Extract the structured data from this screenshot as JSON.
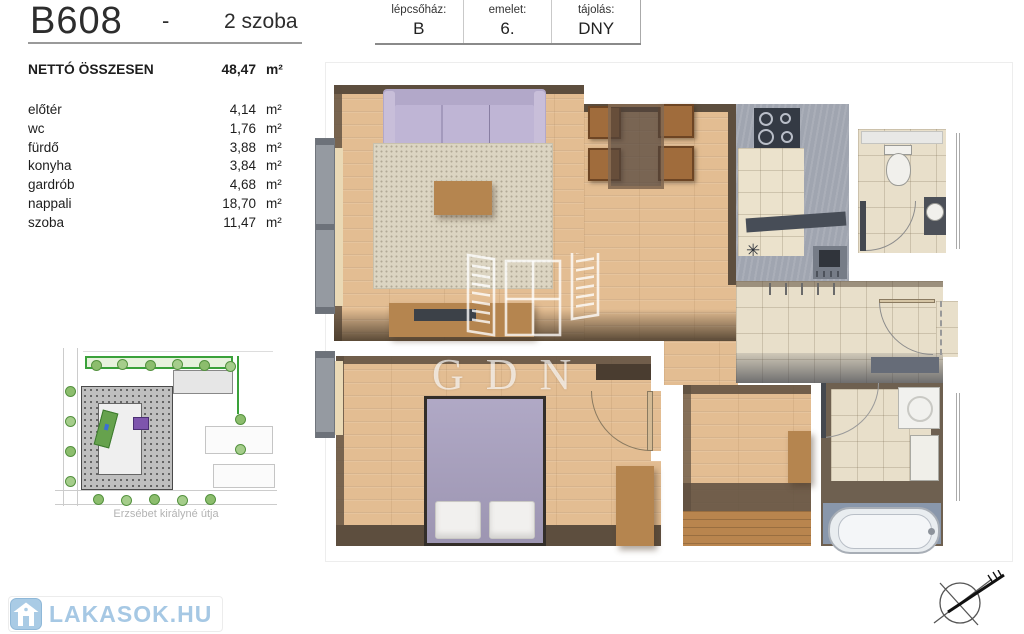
{
  "header": {
    "unit_code": "B608",
    "separator": "-",
    "rooms_label": "2 szoba"
  },
  "info_table": {
    "staircase_label": "lépcsőház:",
    "staircase_value": "B",
    "floor_label": "emelet:",
    "floor_value": "6.",
    "orientation_label": "tájolás:",
    "orientation_value": "DNY"
  },
  "area_table": {
    "total_label": "NETTÓ ÖSSZESEN",
    "total_value": "48,47",
    "total_unit": "m²",
    "rows": [
      {
        "name": "előtér",
        "value": "4,14",
        "unit": "m²"
      },
      {
        "name": "wc",
        "value": "1,76",
        "unit": "m²"
      },
      {
        "name": "fürdő",
        "value": "3,88",
        "unit": "m²"
      },
      {
        "name": "konyha",
        "value": "3,84",
        "unit": "m²"
      },
      {
        "name": "gardrób",
        "value": "4,68",
        "unit": "m²"
      },
      {
        "name": "nappali",
        "value": "18,70",
        "unit": "m²"
      },
      {
        "name": "szoba",
        "value": "11,47",
        "unit": "m²"
      }
    ]
  },
  "floor_plan": {
    "watermark_text": "GDN",
    "kitchen_symbol": "✳",
    "colors": {
      "wood_floor": "#e3bd92",
      "tile_floor": "#e8dfca",
      "kitchen_floor": "#a0a5b0",
      "wall_shadow": "#5d4e3e",
      "sofa_lavender": "#b2a8c9",
      "bed_lavender": "#aaa2c1",
      "rug_beige": "#dcd5c2",
      "furniture_wood": "#b5854f",
      "bathroom_dark": "#6e6050",
      "bath_floor_blue": "#8997ab"
    }
  },
  "site_plan": {
    "street_label": "Erzsébet királyné útja",
    "highlight_color": "#7e55ad",
    "green_color": "#3aa13a"
  },
  "branding": {
    "logo_text": "LAKASOK.HU",
    "logo_color": "#a6c8e4"
  }
}
